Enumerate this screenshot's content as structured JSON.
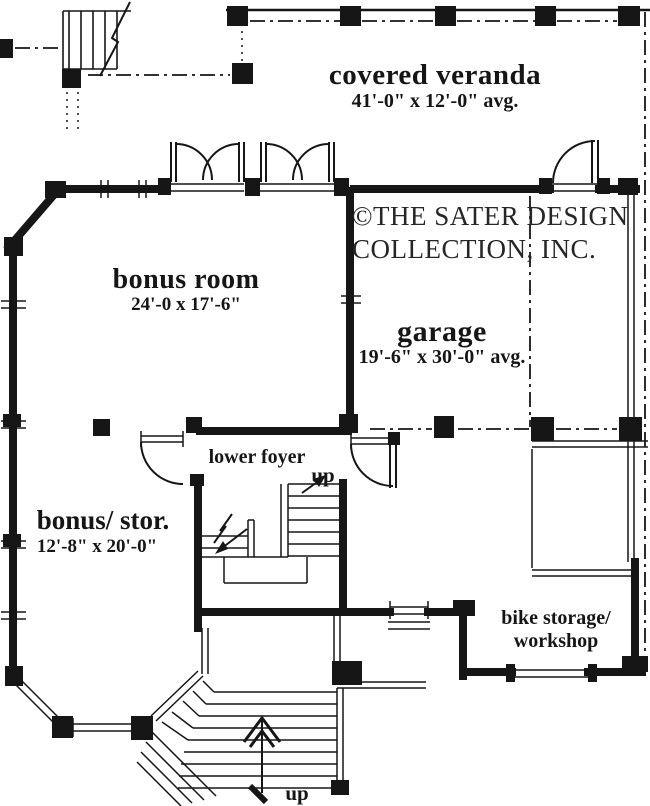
{
  "plan": {
    "copyright": {
      "line1": "©THE SATER DESIGN",
      "line2": "COLLECTION, INC."
    },
    "rooms": {
      "covered_veranda": {
        "name": "covered veranda",
        "dims": "41'-0\" x 12'-0\" avg."
      },
      "bonus_room": {
        "name": "bonus room",
        "dims": "24'-0 x 17'-6\""
      },
      "garage": {
        "name": "garage",
        "dims": "19'-6\" x 30'-0\" avg."
      },
      "lower_foyer": {
        "name": "lower foyer"
      },
      "bonus_storage": {
        "name": "bonus/ stor.",
        "dims": "12'-8\" x 20'-0\""
      },
      "bike_storage": {
        "name_line1": "bike storage/",
        "name_line2": "workshop"
      }
    },
    "annotations": {
      "up_interior": "up",
      "up_exterior": "up"
    },
    "colors": {
      "ink": "#161616",
      "paper": "#ffffff"
    }
  }
}
